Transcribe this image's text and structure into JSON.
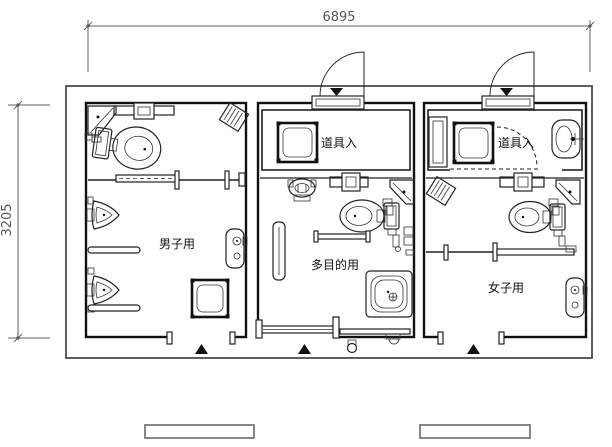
{
  "drawing": {
    "type": "floor-plan",
    "dimensions": {
      "width_mm": "6895",
      "height_mm": "3205"
    },
    "rooms": {
      "mens": {
        "label": "男子用"
      },
      "multipurpose": {
        "label": "多目的用"
      },
      "womens": {
        "label": "女子用"
      }
    },
    "storage": {
      "mid": {
        "label": "道具入"
      },
      "right": {
        "label": "道具入"
      }
    },
    "icons": [
      "toilet-icon",
      "urinal-icon",
      "corner-sink-icon",
      "sink-icon",
      "wash-basin-icon",
      "utility-sink-icon",
      "mop-basin-icon",
      "exhaust-fan-icon",
      "cistern-shelf-icon",
      "drinking-fountain-icon",
      "door-swing-icon",
      "sliding-door-icon",
      "entrance-marker",
      "entrance-mat"
    ],
    "colors": {
      "line": "#111111",
      "outline": "#4d4d4d",
      "dimension": "#555555",
      "background": "#ffffff"
    }
  }
}
